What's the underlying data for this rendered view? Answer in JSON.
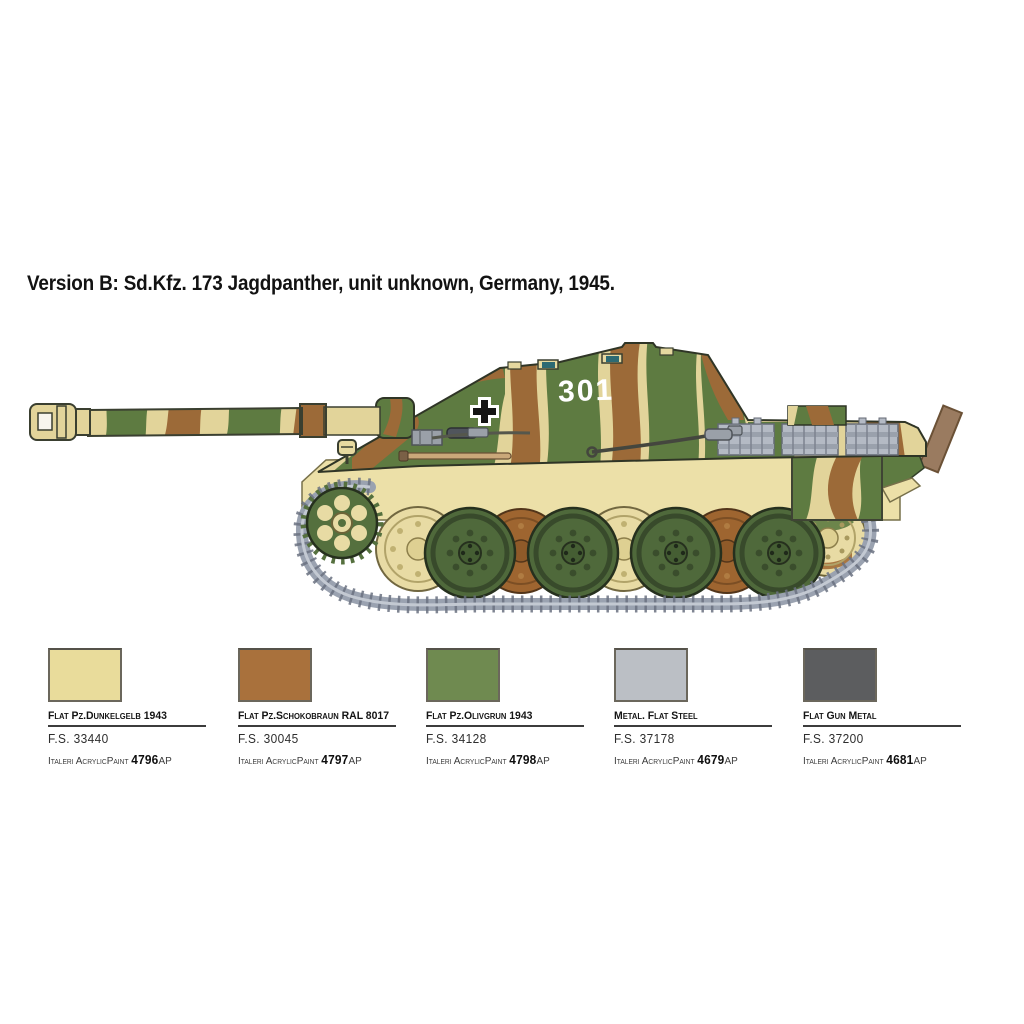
{
  "title": "Version B: Sd.Kfz. 173 Jagdpanther, unit unknown, Germany, 1945.",
  "illustration": {
    "description": "Left side profile of a Sd.Kfz. 173 Jagdpanther tank destroyer in three-tone wavy camouflage",
    "turret_number": "301",
    "marking": "German Balkenkreuz cross",
    "camouflage": {
      "dunkelgelb_tan": "#e2d49a",
      "schokobraun_brown": "#9c6a38",
      "olivgrun_green": "#5e7b41",
      "hull_pale_yellow": "#ece0a8",
      "track_gray": "#9aa2b0",
      "wheel_green": "#4f693b",
      "wheel_brown": "#9e6530",
      "wood_plank_brown": "#9a7b60"
    }
  },
  "paint_chart": {
    "brand_prefix": "Italeri AcrylicPaint",
    "colors": [
      {
        "name": "Flat Pz.Dunkelgelb 1943",
        "fs": "F.S. 33440",
        "code": "4796",
        "code_suffix": "AP",
        "hex": "#e9dc9b"
      },
      {
        "name": "Flat Pz.Schokobraun RAL 8017",
        "fs": "F.S. 30045",
        "code": "4797",
        "code_suffix": "AP",
        "hex": "#a9713c"
      },
      {
        "name": "Flat Pz.Olivgrun 1943",
        "fs": "F.S. 34128",
        "code": "4798",
        "code_suffix": "AP",
        "hex": "#6f8a50"
      },
      {
        "name": "Metal. Flat Steel",
        "fs": "F.S. 37178",
        "code": "4679",
        "code_suffix": "AP",
        "hex": "#bbbfc5"
      },
      {
        "name": "Flat Gun Metal",
        "fs": "F.S. 37200",
        "code": "4681",
        "code_suffix": "AP",
        "hex": "#5c5d5f"
      }
    ]
  }
}
